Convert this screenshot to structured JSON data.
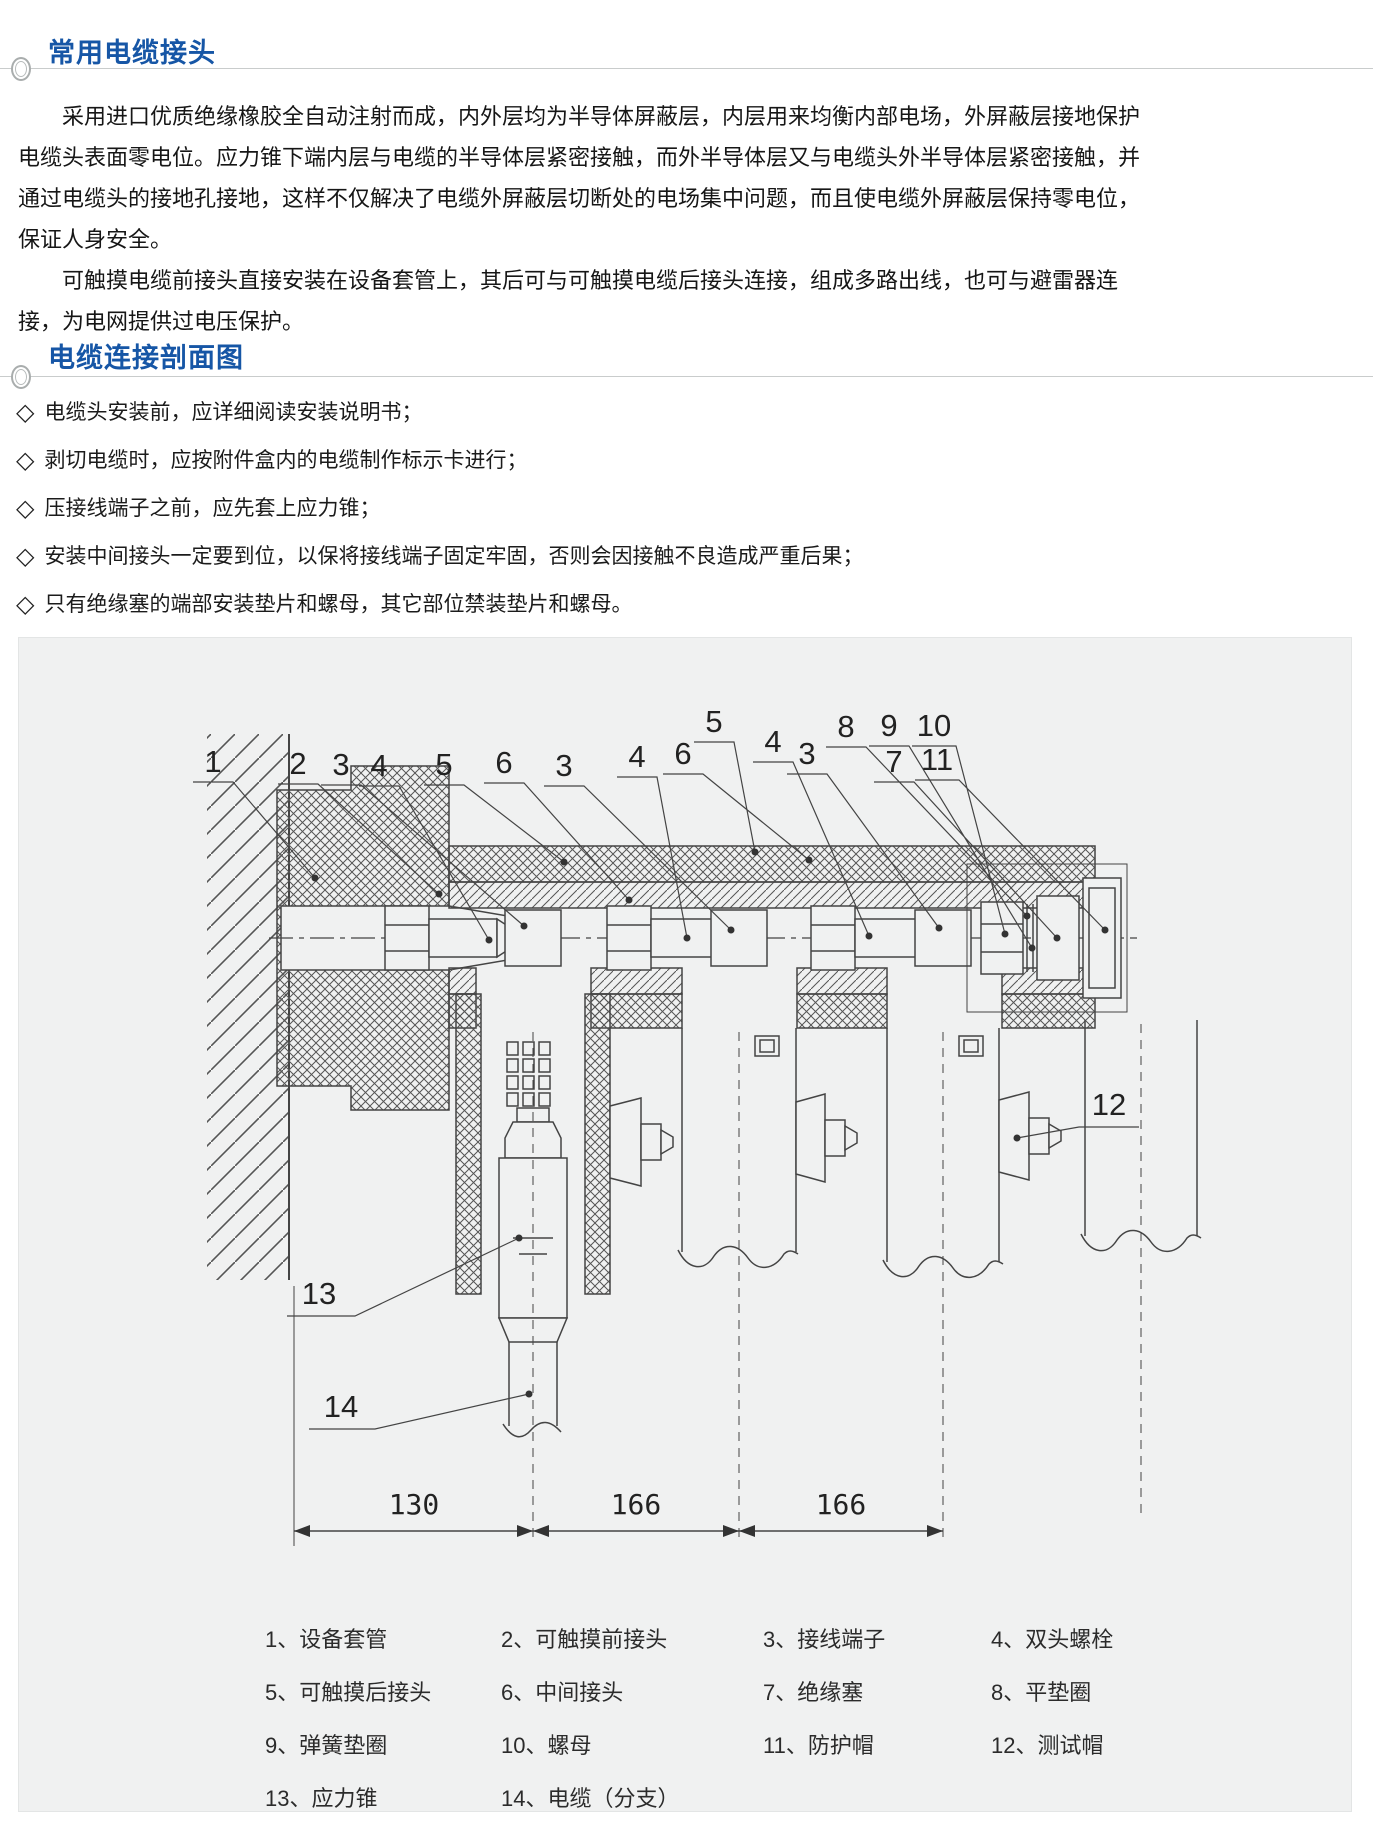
{
  "sections": {
    "title_1": "常用电缆接头",
    "title_2": "电缆连接剖面图"
  },
  "intro": {
    "paragraph_1": "采用进口优质绝缘橡胶全自动注射而成，内外层均为半导体屏蔽层，内层用来均衡内部电场，外屏蔽层接地保护电缆头表面零电位。应力锥下端内层与电缆的半导体层紧密接触，而外半导体层又与电缆头外半导体层紧密接触，并通过电缆头的接地孔接地，这样不仅解决了电缆外屏蔽层切断处的电场集中问题，而且使电缆外屏蔽层保持零电位，保证人身安全。",
    "paragraph_2": "可触摸电缆前接头直接安装在设备套管上，其后可与可触摸电缆后接头连接，组成多路出线，也可与避雷器连接，为电网提供过电压保护。"
  },
  "notes": {
    "bullet_char": "◇",
    "items": [
      "电缆头安装前，应详细阅读安装说明书；",
      "剥切电缆时，应按附件盒内的电缆制作标示卡进行；",
      "压接线端子之前，应先套上应力锥；",
      "安装中间接头一定要到位，以保将接线端子固定牢固，否则会因接触不良造成严重后果；",
      "只有绝缘塞的端部安装垫片和螺母，其它部位禁装垫片和螺母。"
    ]
  },
  "diagram": {
    "callouts": [
      "1",
      "2",
      "3",
      "4",
      "5",
      "6",
      "3",
      "4",
      "6",
      "5",
      "4",
      "3",
      "8",
      "9",
      "10",
      "7",
      "11"
    ],
    "side_callouts": [
      "13",
      "14",
      "12"
    ],
    "dimensions": [
      "130",
      "166",
      "166"
    ],
    "legend": [
      "1、设备套管",
      "2、可触摸前接头",
      "3、接线端子",
      "4、双头螺栓",
      "5、可触摸后接头",
      "6、中间接头",
      "7、绝缘塞",
      "8、平垫圈",
      "9、弹簧垫圈",
      "10、螺母",
      "11、防护帽",
      "12、测试帽",
      "13、应力锥",
      "14、电缆（分支）"
    ]
  },
  "colors": {
    "accent_blue": "#1656a6",
    "panel_bg": "#f0f1f1",
    "rule_gray": "#c9cccc",
    "ink": "#444444"
  }
}
